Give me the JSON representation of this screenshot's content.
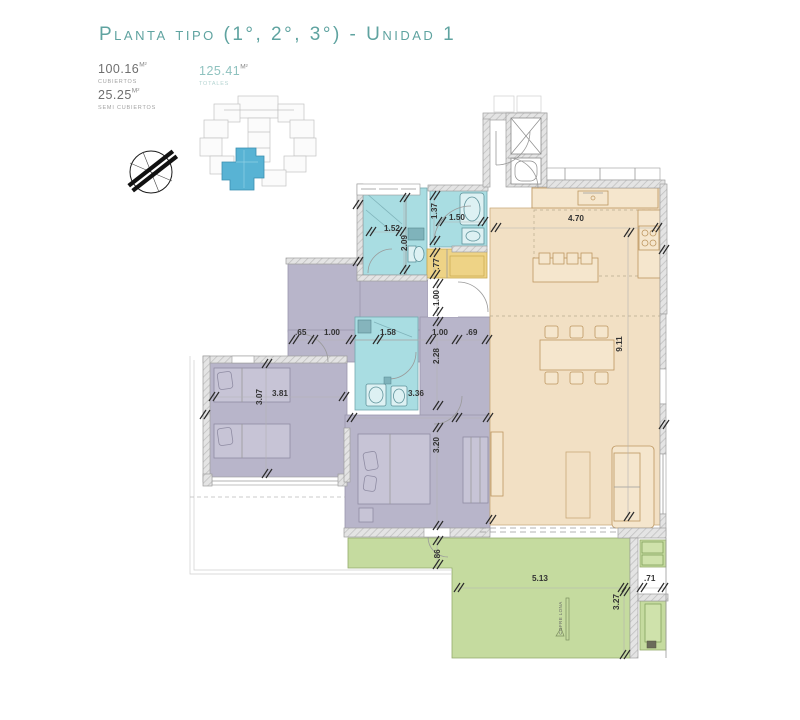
{
  "header": {
    "title": "Planta tipo (1°, 2°, 3°) - Unidad 1",
    "stats": [
      {
        "value": "100.16",
        "unit": "M²",
        "label": "CUBIERTOS"
      },
      {
        "value": "25.25",
        "unit": "M²",
        "label": "SEMI CUBIERTOS"
      },
      {
        "value": "125.41",
        "unit": "M²",
        "label": "TOTALES"
      }
    ]
  },
  "plan": {
    "dims": {
      "d_152": "1.52",
      "d_209": "2.09",
      "d_137": "1.37",
      "d_150": "1.50",
      "d_470": "4.70",
      "d_077": ".77",
      "d_100v": "1.00",
      "d_065": ".65",
      "d_100a": "1.00",
      "d_158": "1.58",
      "d_100b": "1.00",
      "d_069": ".69",
      "d_228": "2.28",
      "d_911": "9.11",
      "d_307": "3.07",
      "d_381": "3.81",
      "d_336": "3.36",
      "d_320": "3.20",
      "d_086": ".86",
      "d_513": "5.13",
      "d_071": ".71",
      "d_327": "3.27"
    },
    "labels": {
      "awning": "COFRE LONA"
    }
  },
  "colors": {
    "title_teal": "#5fa3a0",
    "total_teal": "#8fc2bf",
    "bedroom_purple": "#b8b5ca",
    "bathroom_cyan": "#a9dde2",
    "living_tan": "#f2e0c4",
    "service_yellow": "#eed386",
    "terrace_green": "#c5db9f",
    "keyplan_blue": "#58b3d4",
    "wall_gray": "#e2e2e2",
    "dim_text": "#333333"
  }
}
